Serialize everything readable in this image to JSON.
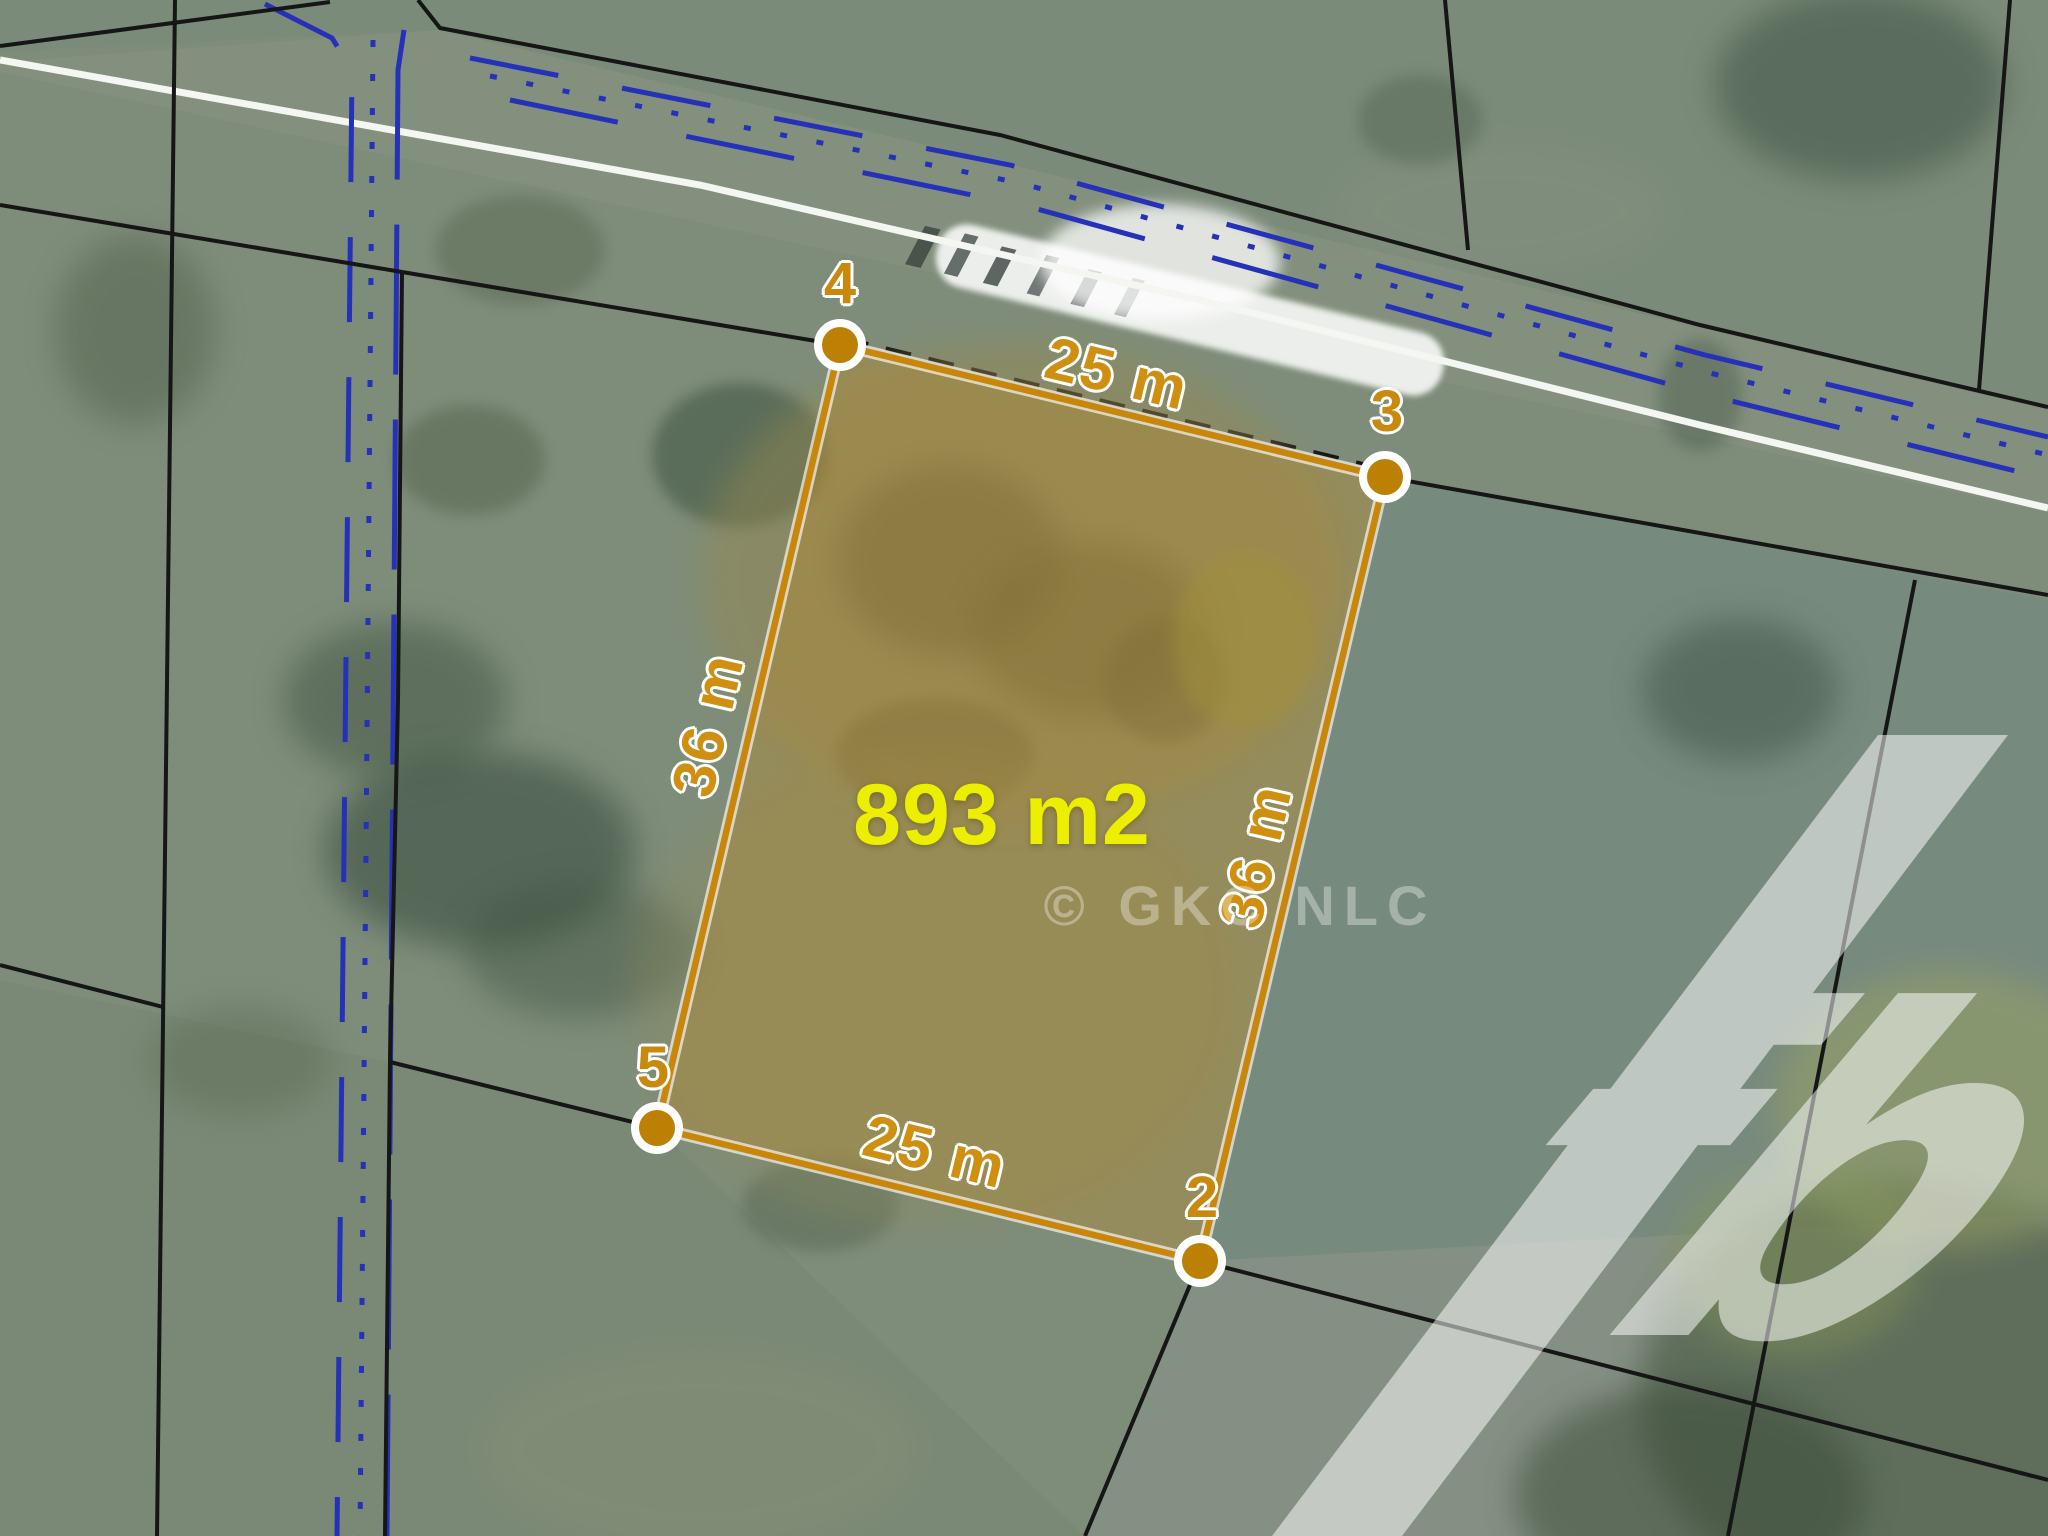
{
  "parcel": {
    "area_label": "893 m2",
    "vertices": [
      {
        "id": "4",
        "label": "4"
      },
      {
        "id": "3",
        "label": "3"
      },
      {
        "id": "2",
        "label": "2"
      },
      {
        "id": "5",
        "label": "5"
      }
    ],
    "dimensions": {
      "top": "25 m",
      "bottom": "25 m",
      "left": "36 m",
      "right": "36 m"
    }
  },
  "watermark": {
    "text": "© GKC NLC"
  },
  "logo": {
    "monogram": "fb"
  },
  "colors": {
    "parcel_outline": "#c8860a",
    "marker_fill": "#bc8104",
    "area_text": "#edef00",
    "dimension_text": "#cf9012",
    "utility_blue": "#2531b8",
    "boundary_black": "#161616",
    "road_white": "#f4f6f1"
  }
}
